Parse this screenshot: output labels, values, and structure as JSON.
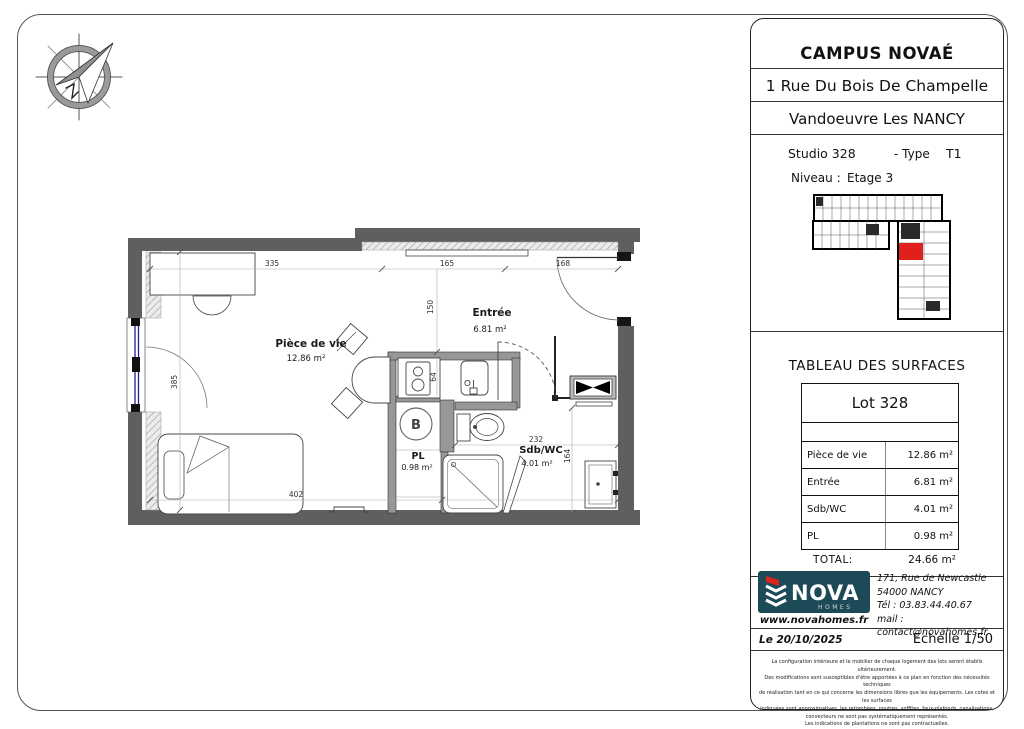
{
  "colors": {
    "wall": "#5f5f5f",
    "partition": "#979797",
    "highlight_red": "#e0201a",
    "logo_teal": "#1c4a57",
    "window_blue": "#20208f"
  },
  "title_block": {
    "project": "CAMPUS NOVAÉ",
    "address_line1": "1 Rue Du Bois De Champelle",
    "address_line2": "Vandoeuvre Les NANCY",
    "unit": {
      "studio": "Studio 328",
      "type_label": "- Type",
      "type_value": "T1",
      "level_label": "Niveau :",
      "level_value": "Etage 3"
    }
  },
  "surfaces": {
    "title": "TABLEAU DES SURFACES",
    "lot": "Lot 328",
    "rows": [
      {
        "label": "Pièce de vie",
        "value": "12.86 m²"
      },
      {
        "label": "Entrée",
        "value": "6.81 m²"
      },
      {
        "label": "Sdb/WC",
        "value": "4.01 m²"
      },
      {
        "label": "PL",
        "value": "0.98 m²"
      }
    ],
    "total_label": "TOTAL:",
    "total_value": "24.66 m²"
  },
  "agency": {
    "brand": "NOVA",
    "brand_sub": "HOMES",
    "website": "www.novahomes.fr",
    "address_line1": "171, Rue de Newcastle",
    "address_line2": "54000 NANCY",
    "phone": "Tél : 03.83.44.40.67",
    "email": "mail : contact@novahomes.fr"
  },
  "footer": {
    "date": "Le 20/10/2025",
    "scale": "Echelle 1/50",
    "disclaimer": [
      "La configuration intérieure et le mobilier de chaque logement des lots seront établis ultérieurement.",
      "Des modifications sont susceptibles d'être apportées à ce plan en fonction des nécessités techniques",
      "de réalisation tant en ce qui concerne les dimensions libres que les équipements. Les cotes et les surfaces",
      "indiquées sont approximatives, les retombées, poutres, soffites, faux-plafonds, canalisations,",
      "convecteurs ne sont pas systématiquement représentés.",
      "Les indications de plantations ne sont pas contractuelles."
    ]
  },
  "plan": {
    "rooms": [
      {
        "name": "Pièce de vie",
        "area": "12.86 m²"
      },
      {
        "name": "Entrée",
        "area": "6.81 m²"
      },
      {
        "name": "PL",
        "area": "0.98 m²"
      },
      {
        "name": "Sdb/WC",
        "area": "4.01 m²"
      }
    ],
    "dimensions": {
      "top_left": "335",
      "top_mid": "165",
      "top_right": "168",
      "entry_depth": "150",
      "left_height": "385",
      "bottom": "402",
      "sdb_width": "232",
      "sdb_height": "164",
      "kitchen_depth": "64"
    },
    "boiler": "B"
  }
}
